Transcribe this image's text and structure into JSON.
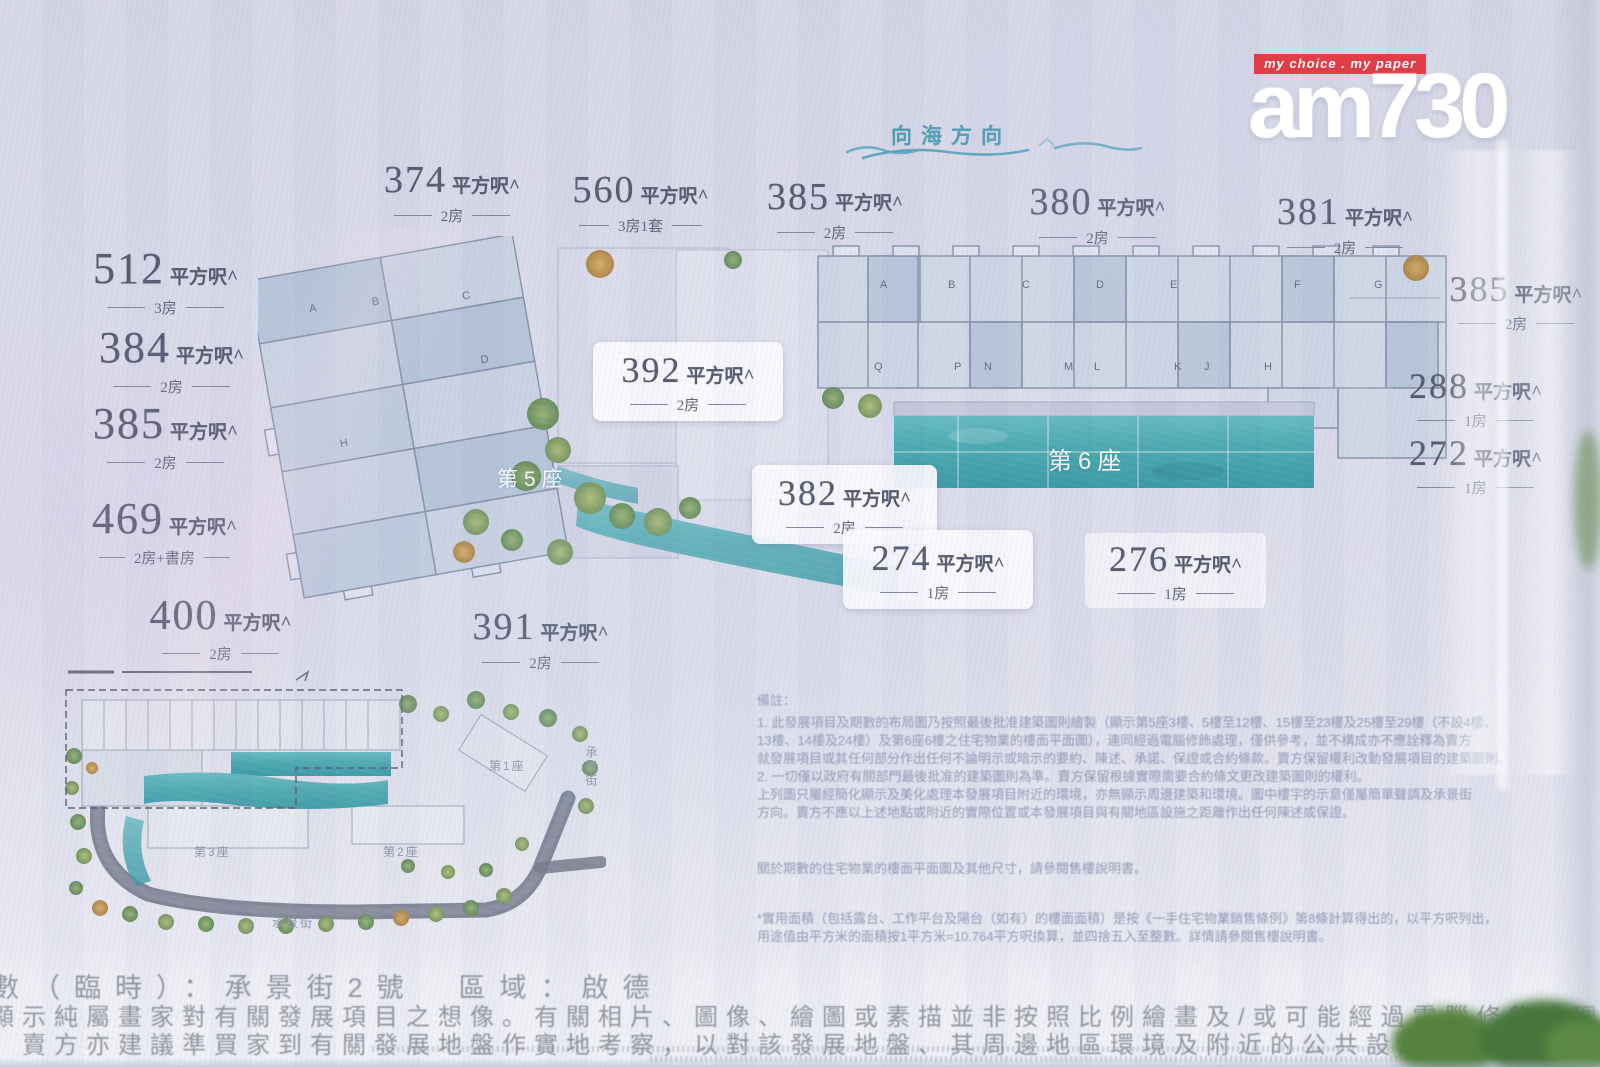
{
  "header": {
    "sea_direction": "向海方向"
  },
  "logo": {
    "tagline": "my choice . my paper",
    "name": "am730"
  },
  "units": {
    "suffix": "平方呎^",
    "left_column": [
      {
        "area": "512",
        "rooms": "3房"
      },
      {
        "area": "384",
        "rooms": "2房"
      },
      {
        "area": "385",
        "rooms": "2房"
      },
      {
        "area": "469",
        "rooms": "2房+書房"
      },
      {
        "area": "400",
        "rooms": "2房"
      }
    ],
    "top_row": [
      {
        "area": "374",
        "rooms": "2房"
      },
      {
        "area": "560",
        "rooms": "3房1套"
      },
      {
        "area": "385",
        "rooms": "2房"
      },
      {
        "area": "380",
        "rooms": "2房"
      },
      {
        "area": "381",
        "rooms": "2房"
      }
    ],
    "middle": [
      {
        "area": "392",
        "rooms": "2房"
      },
      {
        "area": "382",
        "rooms": "2房"
      },
      {
        "area": "274",
        "rooms": "1房"
      },
      {
        "area": "276",
        "rooms": "1房"
      },
      {
        "area": "391",
        "rooms": "2房"
      }
    ],
    "right_column": [
      {
        "area": "385",
        "rooms": "2房"
      },
      {
        "area": "288",
        "rooms": "1房"
      },
      {
        "area": "272",
        "rooms": "1房"
      }
    ]
  },
  "plan": {
    "block5_label": "第5座",
    "block6_label": "第6座",
    "block5_letters": [
      "A",
      "B",
      "C",
      "D",
      "H"
    ],
    "block6_top_letters": [
      "A",
      "B",
      "C",
      "D",
      "E",
      "F",
      "G"
    ],
    "block6_bottom_letters": [
      "Q",
      "P",
      "N",
      "M",
      "L",
      "K",
      "J",
      "H"
    ]
  },
  "inset": {
    "tower1": "第1座",
    "tower2": "第2座",
    "tower3": "第3座",
    "street_bottom": "承景街",
    "street_right": "承豐街"
  },
  "notes": {
    "heading": "備註：",
    "lines": [
      "1. 此發展項目及期數的布局圖乃按照最後批准建築圖則繪製（顯示第5座3樓、5樓至12樓、15樓至23樓及25樓至29樓（不設4樓、",
      "13樓、14樓及24樓）及第6座6樓之住宅物業的樓面平面圖），連同經過電腦修飾處理，僅供參考，並不構成亦不應詮釋為賣方",
      "就發展項目或其任何部分作出任何不論明示或暗示的要約、陳述、承諾、保證或合約條款。賣方保留權利改動發展項目的建築圖則。",
      "2. 一切僅以政府有關部門最後批准的建築圖則為準。賣方保留根據實際需要合約條文更改建築圖則的權利。",
      "上列圖只屬經簡化顯示及美化處理本發展項目附近的環境，亦無顯示周邊建築和環境。圖中樓宇的示意僅屬簡單聲調及承景街",
      "方向。賣方不應以上述地點或附近的實際位置或本發展項目與有關地區設施之距離作出任何陳述或保證。"
    ],
    "para2": "關於期數的住宅物業的樓面平面圖及其他尺寸，請參閱售樓說明書。",
    "para3_lines": [
      "*實用面積（包括露台、工作平台及陽台（如有）的樓面面積）是按《一手住宅物業銷售條例》第8條計算得出的，以平方呎列出，",
      "用途值由平方米的面積按1平方米=10.764平方呎換算，並四捨五入至整數。詳情請參閱售樓說明書。"
    ]
  },
  "bottom": {
    "line1": "數（臨時）：承景街2號　區域：啟德",
    "line2": "顯示純屬畫家對有關發展項目之想像。有關相片、圖像、繪圖或素描並非按照比例繪畫及/或可能經過電腦修飾處理。",
    "line3": "。賣方亦建議準買家到有關發展地盤作實地考察，以對該發展地盤、其周邊地區環境及附近的公共設施有較佳了解。"
  },
  "colors": {
    "accent_teal": "#3e95ae",
    "pool": "#3fa5ac",
    "label_text": "#4c5166",
    "logo_red": "#e03d46"
  }
}
